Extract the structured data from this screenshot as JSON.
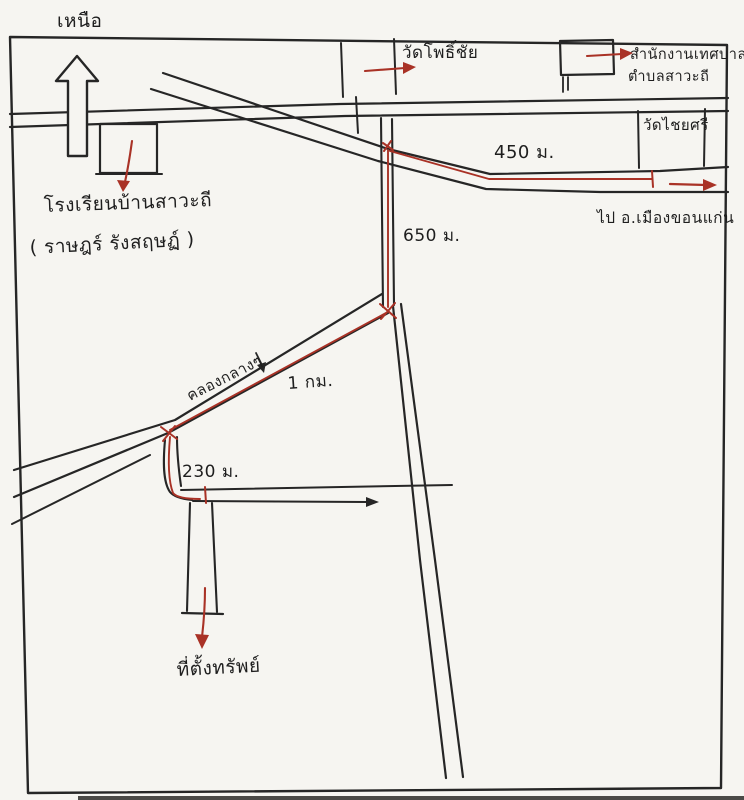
{
  "colors": {
    "paper": "#f6f5f1",
    "ink": "#262626",
    "route_red": "#a93226"
  },
  "map": {
    "compass_label": "เหนือ",
    "school": {
      "name": "โรงเรียนบ้านสาวะถี",
      "subtitle": "( ราษฎร์ รังสฤษฏ์ )"
    },
    "temple_pho_chai": "วัดโพธิ์ชัย",
    "municipality": {
      "line1": "สำนักงานเทศบาล",
      "line2": "ตำบลสาวะถี"
    },
    "temple_chai_si": "วัดไชยศรี",
    "direction_khon_kaen": "ไป อ.เมืองขอนแก่น",
    "road_name": "คลองกลางๆ",
    "distances": {
      "d450": "450 ม.",
      "d650": "650 ม.",
      "d1km": "1 กม.",
      "d230": "230 ม."
    },
    "property_location": "ที่ตั้งทรัพย์"
  }
}
